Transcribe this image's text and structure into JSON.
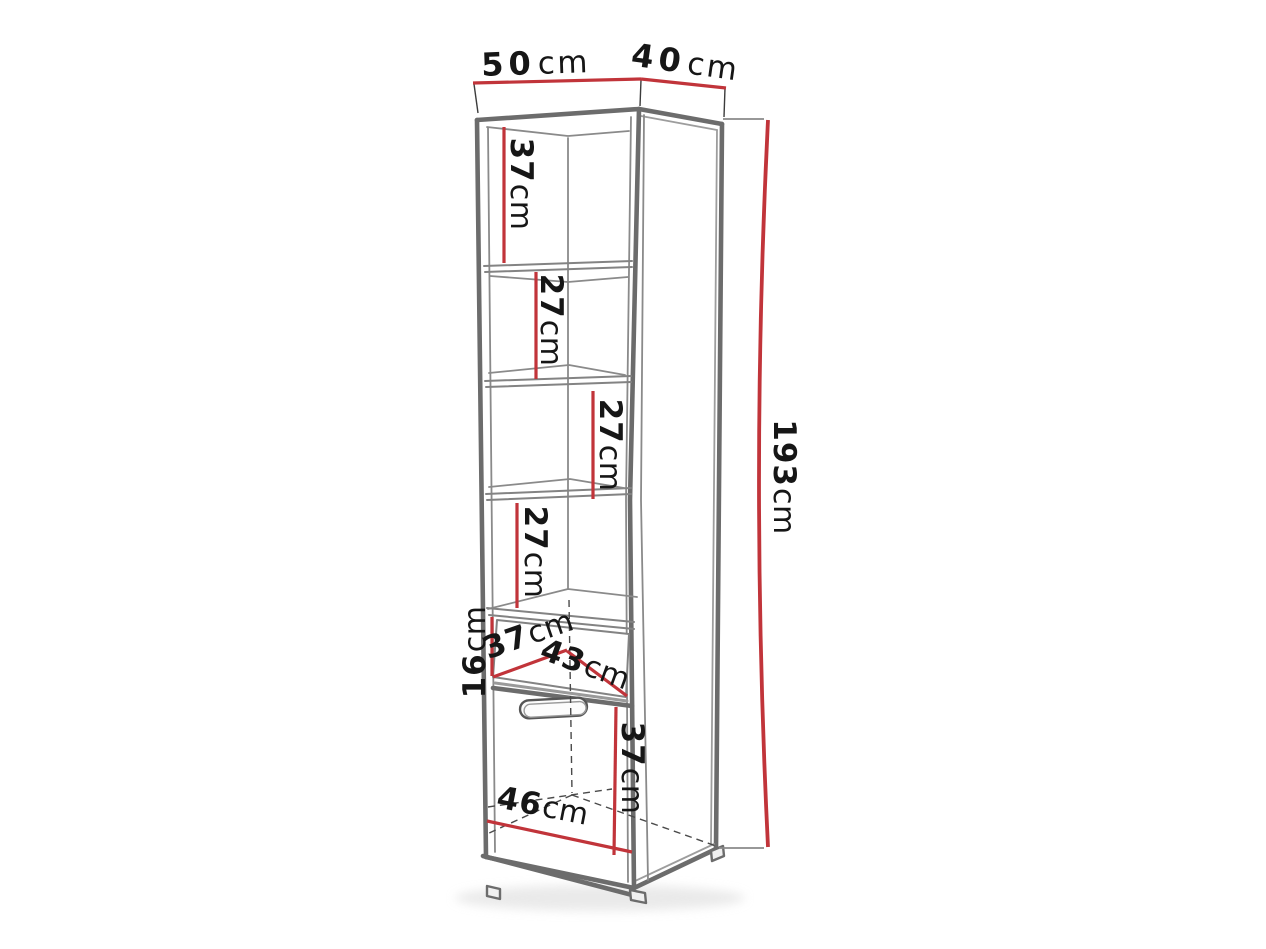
{
  "diagram": {
    "type": "furniture-dimension-drawing",
    "subject": "tall shelving cabinet with four open shelves, one drawer and one bottom door",
    "unit": "cm",
    "colors": {
      "dimension_line": "#c1343a",
      "cabinet_edge": "#6c6c6c",
      "hidden_edge": "#4a4a4a",
      "label_text": "#161616",
      "background": "#ffffff"
    },
    "dimensions": {
      "width_top": {
        "value": "50",
        "unit": "cm",
        "label": "50cm",
        "meaning": "cabinet front width"
      },
      "depth_top": {
        "value": "40",
        "unit": "cm",
        "label": "40cm",
        "meaning": "cabinet side depth"
      },
      "height_right": {
        "value": "193",
        "unit": "cm",
        "label": "193cm",
        "meaning": "total cabinet height"
      },
      "section_1": {
        "value": "37",
        "unit": "cm",
        "label": "37cm",
        "meaning": "top compartment height"
      },
      "section_2": {
        "value": "27",
        "unit": "cm",
        "label": "27cm",
        "meaning": "second compartment height"
      },
      "section_3": {
        "value": "27",
        "unit": "cm",
        "label": "27cm",
        "meaning": "third compartment height"
      },
      "section_4": {
        "value": "27",
        "unit": "cm",
        "label": "27cm",
        "meaning": "fourth compartment height"
      },
      "drawer_height": {
        "value": "16",
        "unit": "cm",
        "label": "16cm",
        "meaning": "drawer front height"
      },
      "drawer_depth": {
        "value": "37",
        "unit": "cm",
        "label": "37cm",
        "meaning": "drawer depth"
      },
      "drawer_width": {
        "value": "43",
        "unit": "cm",
        "label": "43cm",
        "meaning": "drawer width"
      },
      "door_height": {
        "value": "37",
        "unit": "cm",
        "label": "37cm",
        "meaning": "bottom door height"
      },
      "bottom_width": {
        "value": "46",
        "unit": "cm",
        "label": "46cm",
        "meaning": "inner bottom width"
      }
    }
  }
}
